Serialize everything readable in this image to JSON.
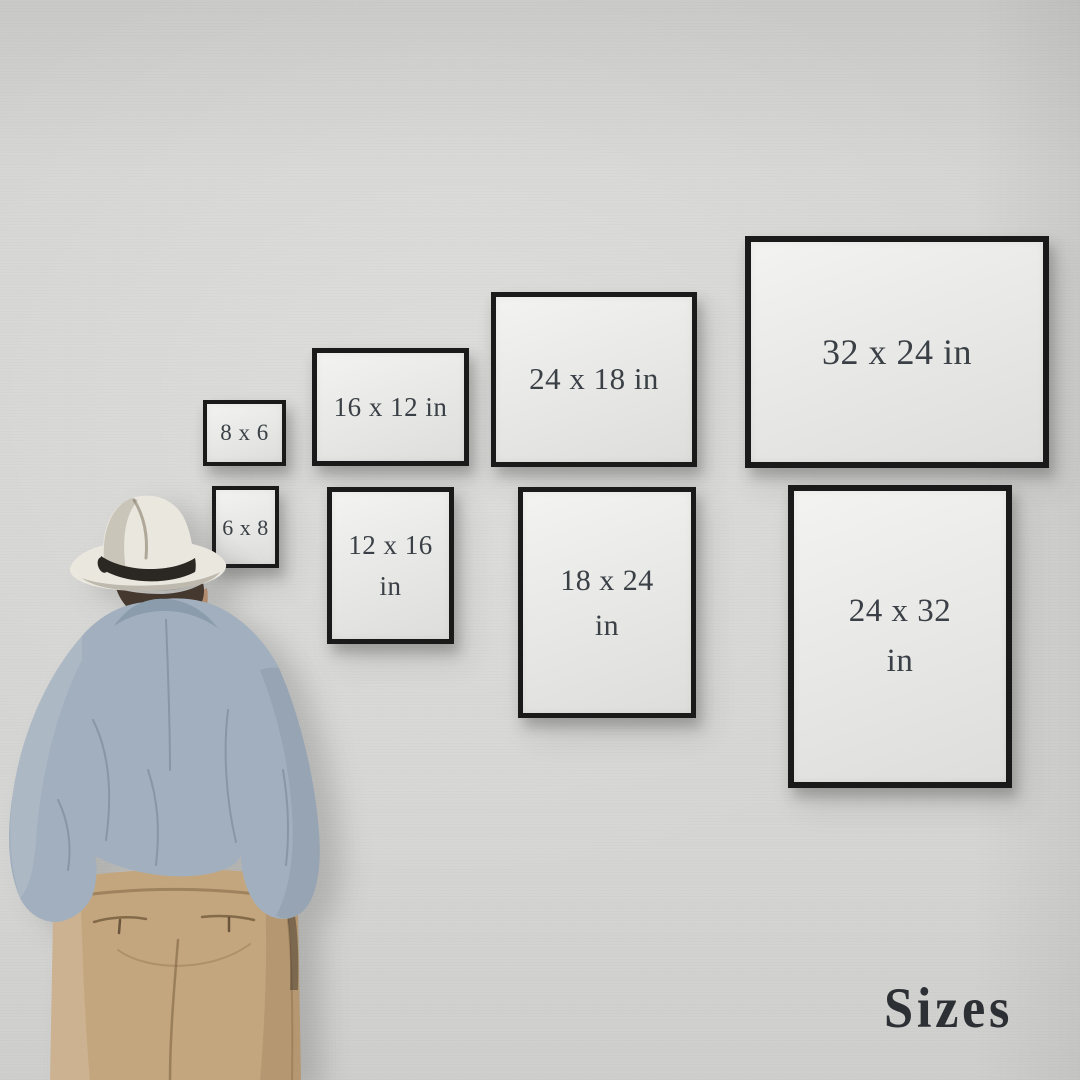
{
  "caption": {
    "text": "Sizes"
  },
  "frames": [
    {
      "label": "8 x 6",
      "orientation": "landscape"
    },
    {
      "label": "16 x 12 in",
      "orientation": "landscape"
    },
    {
      "label": "24 x 18 in",
      "orientation": "landscape"
    },
    {
      "label": "32 x 24 in",
      "orientation": "landscape"
    },
    {
      "label": "6 x 8",
      "orientation": "portrait"
    },
    {
      "label": "12 x 16 in",
      "orientation": "portrait"
    },
    {
      "label": "18 x 24 in",
      "orientation": "portrait"
    },
    {
      "label": "24 x 32 in",
      "orientation": "portrait"
    }
  ],
  "colors": {
    "wall": "#d5d5d3",
    "frame_border": "#1a1a1a",
    "frame_canvas": "#e9e9e7",
    "label_text": "#3a4046",
    "caption_text": "#2c3034",
    "hat": "#eae7de",
    "hat_band": "#2b2723",
    "hair": "#44382f",
    "skin": "#b28a6d",
    "shirt": "#a2afbe",
    "shirt_dark": "#8b9cac",
    "pants": "#c4a67e",
    "pants_dark": "#ac8d65"
  }
}
